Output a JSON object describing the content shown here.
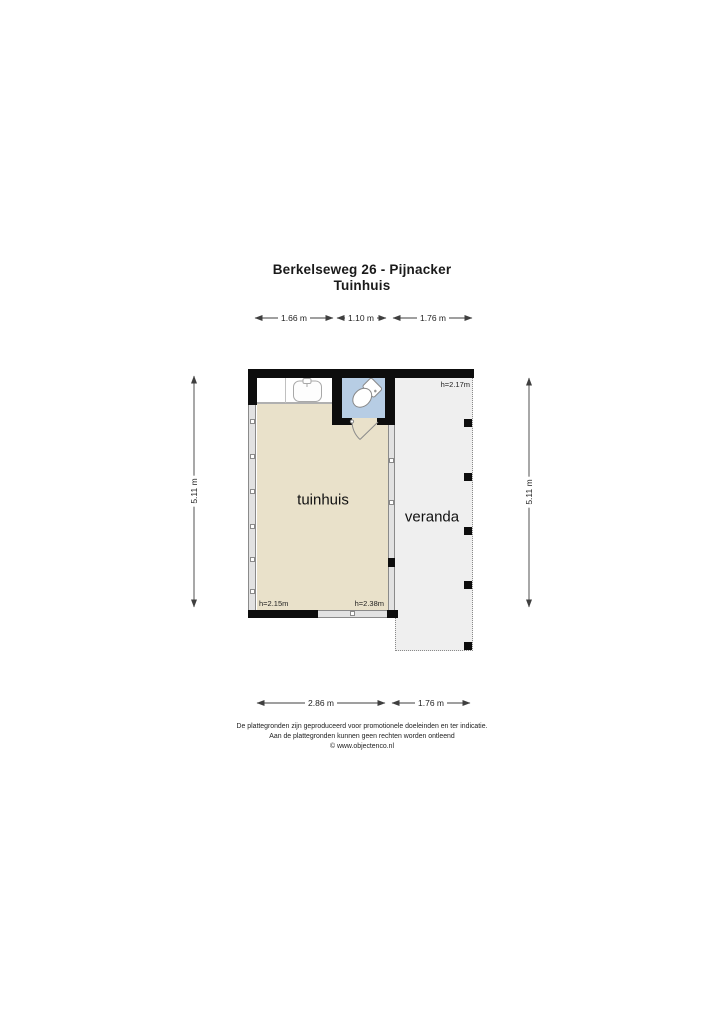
{
  "title": {
    "line1": "Berkelseweg 26 - Pijnacker",
    "line2": "Tuinhuis"
  },
  "dimensions": {
    "top": [
      {
        "label": "1.66 m"
      },
      {
        "label": "1.10 m"
      },
      {
        "label": "1.76 m"
      }
    ],
    "left": {
      "label": "5.11 m"
    },
    "right": {
      "label": "5.11 m"
    },
    "bottom": [
      {
        "label": "2.86 m"
      },
      {
        "label": "1.76 m"
      }
    ]
  },
  "rooms": {
    "tuinhuis": {
      "label": "tuinhuis",
      "height_left": "h=2.15m",
      "height_right": "h=2.38m",
      "floor_color": "#e9e1ca"
    },
    "toilet": {
      "floor_color": "#b7cde4",
      "fixtures": [
        "toilet",
        "sink"
      ]
    },
    "veranda": {
      "label": "veranda",
      "height": "h=2.17m",
      "floor_color": "#efefef"
    }
  },
  "footer": {
    "line1": "De plattegronden zijn geproduceerd voor promotionele doeleinden en ter indicatie.",
    "line2": "Aan de plattegronden kunnen geen rechten worden ontleend",
    "line3": "© www.objectenco.nl"
  },
  "colors": {
    "wall": "#0d0d0d",
    "window_frame": "#8a8a8a",
    "dimension_line": "#3f3f3f"
  }
}
